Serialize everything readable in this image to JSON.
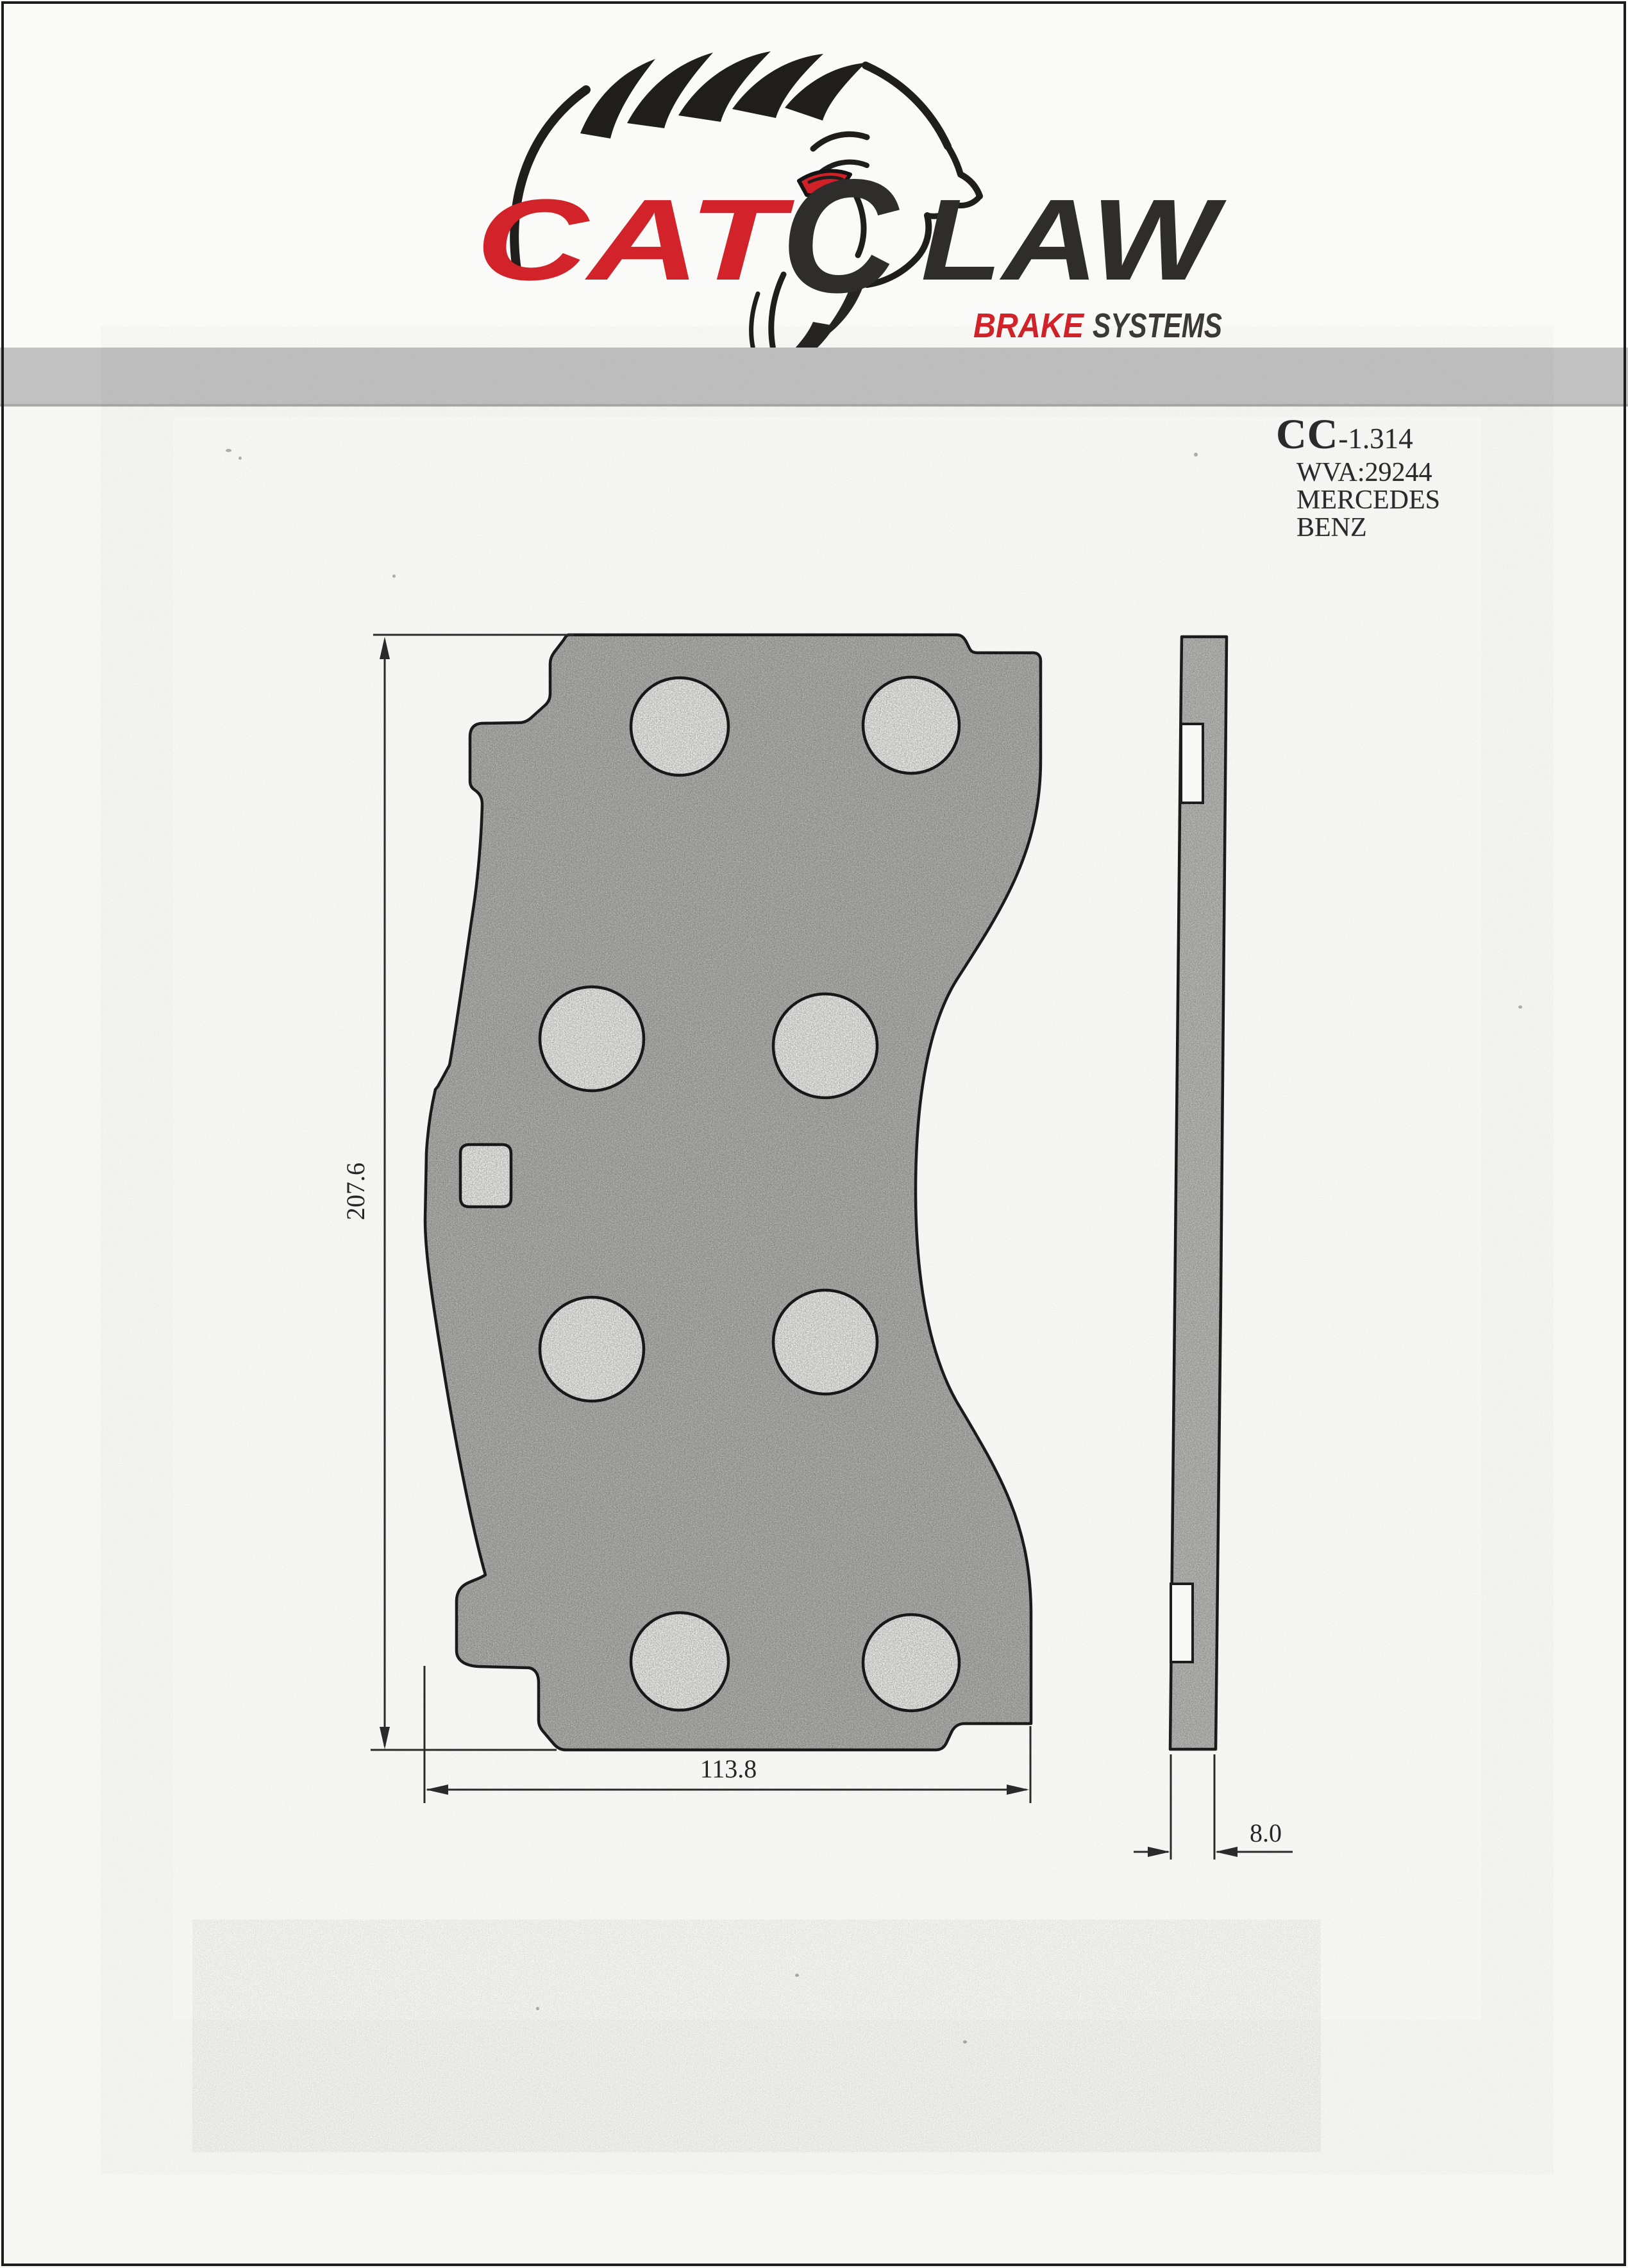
{
  "page": {
    "kind": "scanned brake pad specification sheet",
    "bg": "#f7f7f5",
    "border_color": "#1c1c1c",
    "divider_band_color": "#c1c1c1"
  },
  "logo": {
    "cat": "CAT",
    "claw_c": "C",
    "law": "LAW",
    "brake": "BRAKE",
    "systems": "SYSTEMS",
    "red": "#d2232a",
    "dark": "#2e2d2c",
    "icon": "lion-head-sketch"
  },
  "part_info": {
    "series": "CC",
    "code": "-1.314",
    "wva": "WVA:29244",
    "brand_line1": "MERCEDES",
    "brand_line2": "BENZ"
  },
  "drawing": {
    "dimensions": {
      "height_mm": "207.6",
      "width_mm": "113.8",
      "thickness_mm": "8.0"
    },
    "features": {
      "round_holes": 8,
      "square_holes": 1,
      "side_view_notches": 2
    },
    "ink": "#1d1d1d",
    "pad_fill": "#b9b9b7"
  }
}
